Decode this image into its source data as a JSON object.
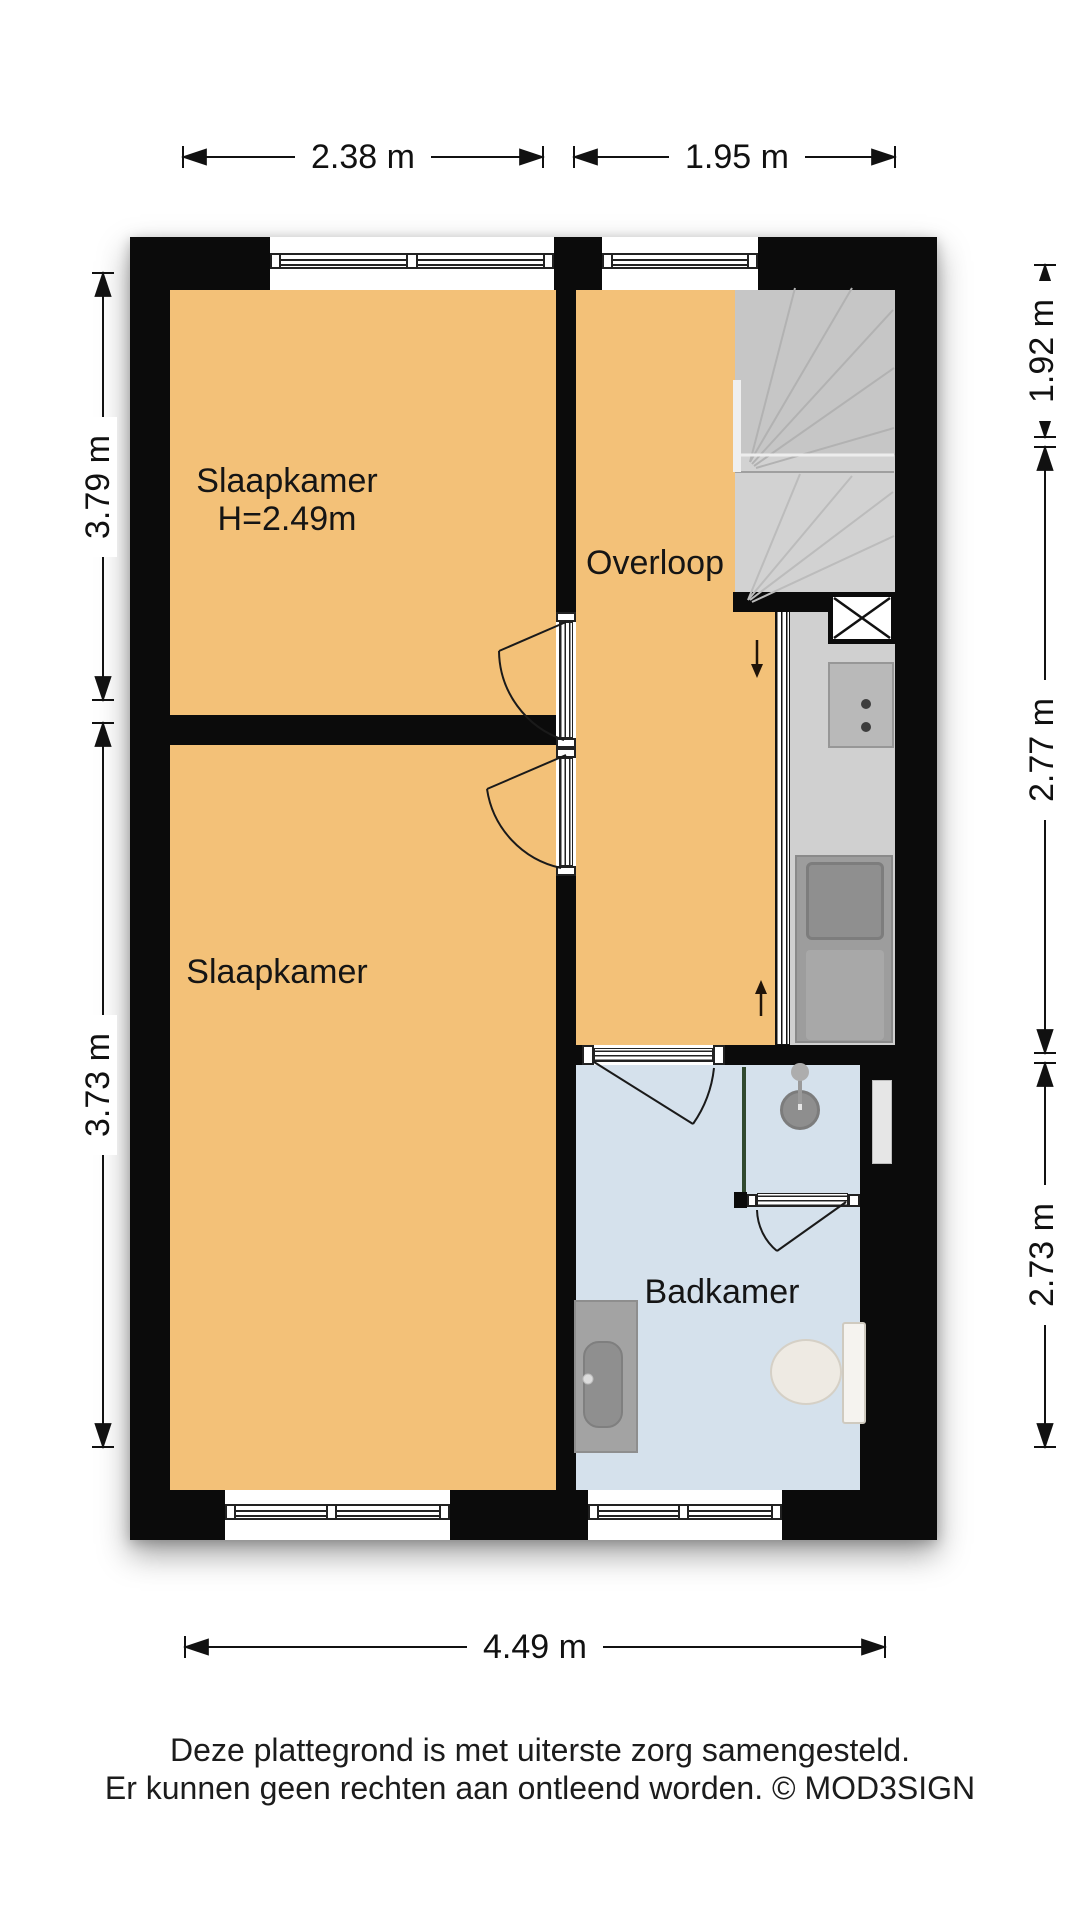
{
  "rooms": {
    "bedroom_top": {
      "label": "Slaapkamer",
      "height_note": "H=2.49m"
    },
    "bedroom_bottom": {
      "label": "Slaapkamer"
    },
    "landing": {
      "label": "Overloop"
    },
    "bathroom": {
      "label": "Badkamer"
    }
  },
  "dimensions": {
    "top": [
      "2.38 m",
      "1.95 m"
    ],
    "left": [
      "3.79 m",
      "3.73 m"
    ],
    "right": [
      "1.92 m",
      "2.77 m",
      "2.73 m"
    ],
    "bottom": [
      "4.49 m"
    ]
  },
  "footer": {
    "line1": "Deze plattegrond is met uiterste zorg samengesteld.",
    "line2": "Er kunnen geen rechten aan ontleend worden. © MOD3SIGN"
  },
  "colors": {
    "room_fill": "#F3C178",
    "bathroom_fill": "#D5E1EC",
    "wall": "#0B0B0B",
    "stairs_upper": "#C6C6C6",
    "stairs_lower": "#D2D2D2",
    "glass_partition": "#31492F"
  }
}
